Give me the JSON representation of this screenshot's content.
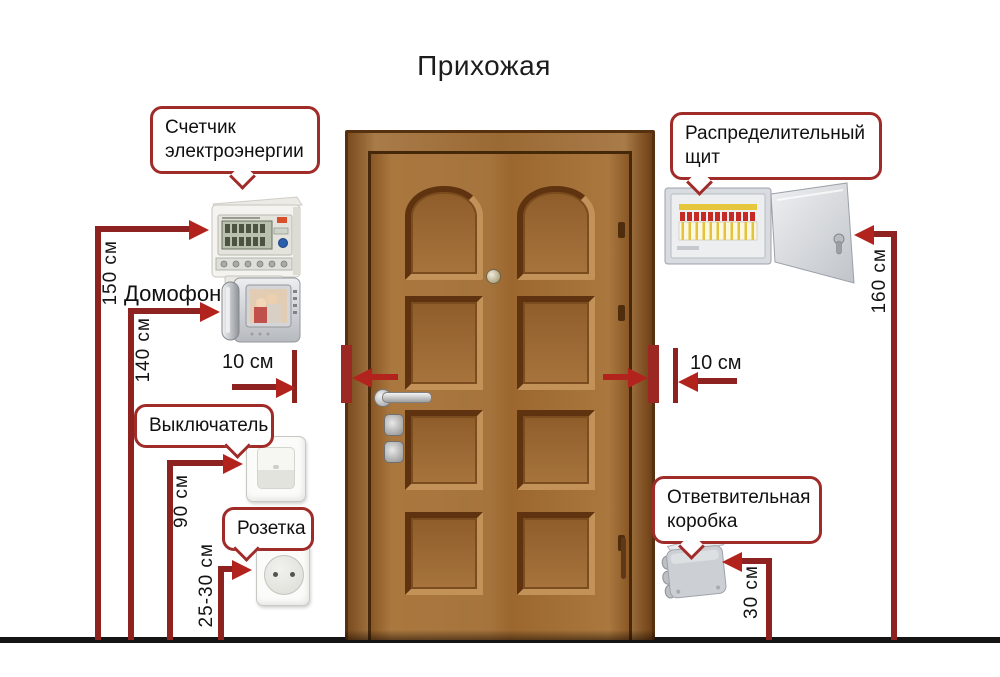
{
  "title": "Прихожая",
  "labels": {
    "meter": "Счетчик электроэнергии",
    "intercom": "Домофон",
    "switch": "Выключатель",
    "socket": "Розетка",
    "panel": "Распределительный щит",
    "junction": "Ответвительная коробка"
  },
  "measurements": {
    "meter": "150 см",
    "intercom": "140 см",
    "switch": "90 см",
    "socket": "25-30 см",
    "panel": "160 см",
    "junction": "30 см",
    "door_left": "10 см",
    "door_right": "10 см"
  },
  "colors": {
    "measurement_line": "#8d2220",
    "arrow_red": "#b3231e",
    "bubble_border": "#a02c2a",
    "floor_line": "#151515",
    "door_wood": "#9b6a38"
  },
  "devices": [
    "electricity-meter",
    "video-intercom",
    "light-switch",
    "power-socket",
    "distribution-board",
    "junction-box"
  ]
}
